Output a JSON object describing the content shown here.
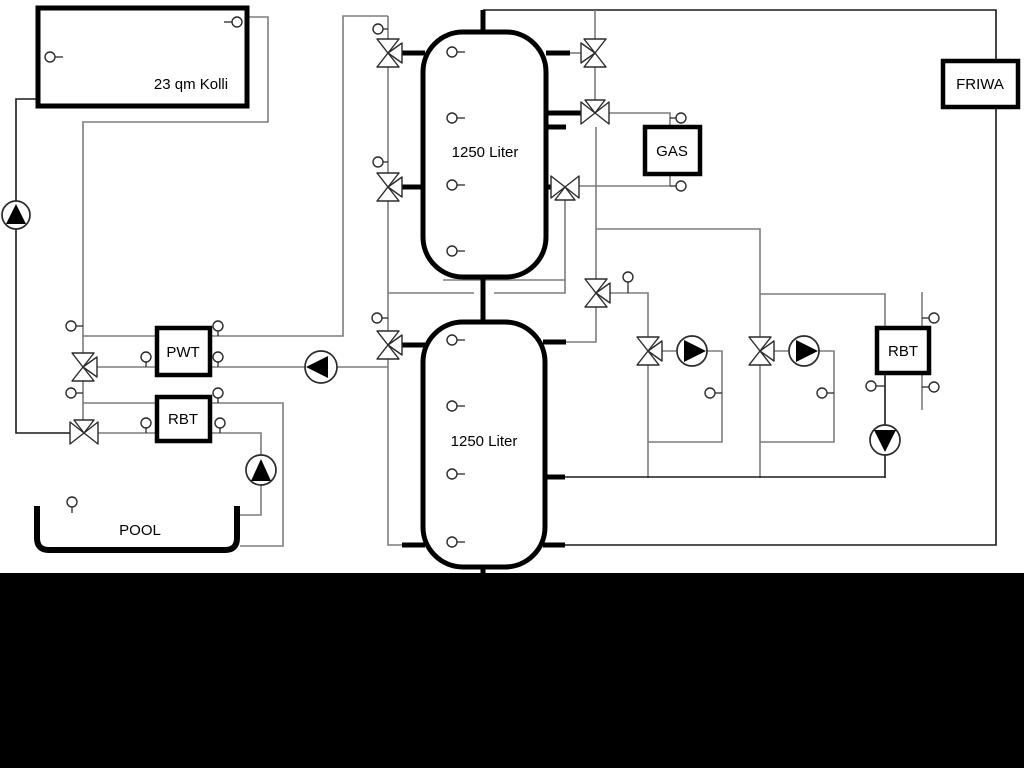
{
  "diagram": {
    "type": "heating-system-hydraulic-schematic",
    "labels": {
      "collector": "23 qm Kolli",
      "tank1": "1250 Liter",
      "tank2": "1250 Liter",
      "gas": "GAS",
      "friwa": "FRIWA",
      "pwt": "PWT",
      "rbt_left": "RBT",
      "rbt_right": "RBT",
      "pool": "POOL"
    },
    "colors": {
      "background": "#ffffff",
      "pipe_gray": "#7d7d7d",
      "pipe_dark": "#1a1a1a",
      "outline": "#000000",
      "pump_fill": "#000000",
      "letterbox_band": "#000000"
    },
    "components": {
      "boxes": [
        "solar-collector",
        "buffer-tank-1",
        "buffer-tank-2",
        "gas-boiler",
        "friwa-station",
        "pwt-heat-exchanger",
        "rbt-heat-exchanger-left",
        "rbt-heat-exchanger-right",
        "pool-basin"
      ],
      "pumps": 6,
      "three_way_valves": 11,
      "temperature_sensors": 27
    }
  }
}
